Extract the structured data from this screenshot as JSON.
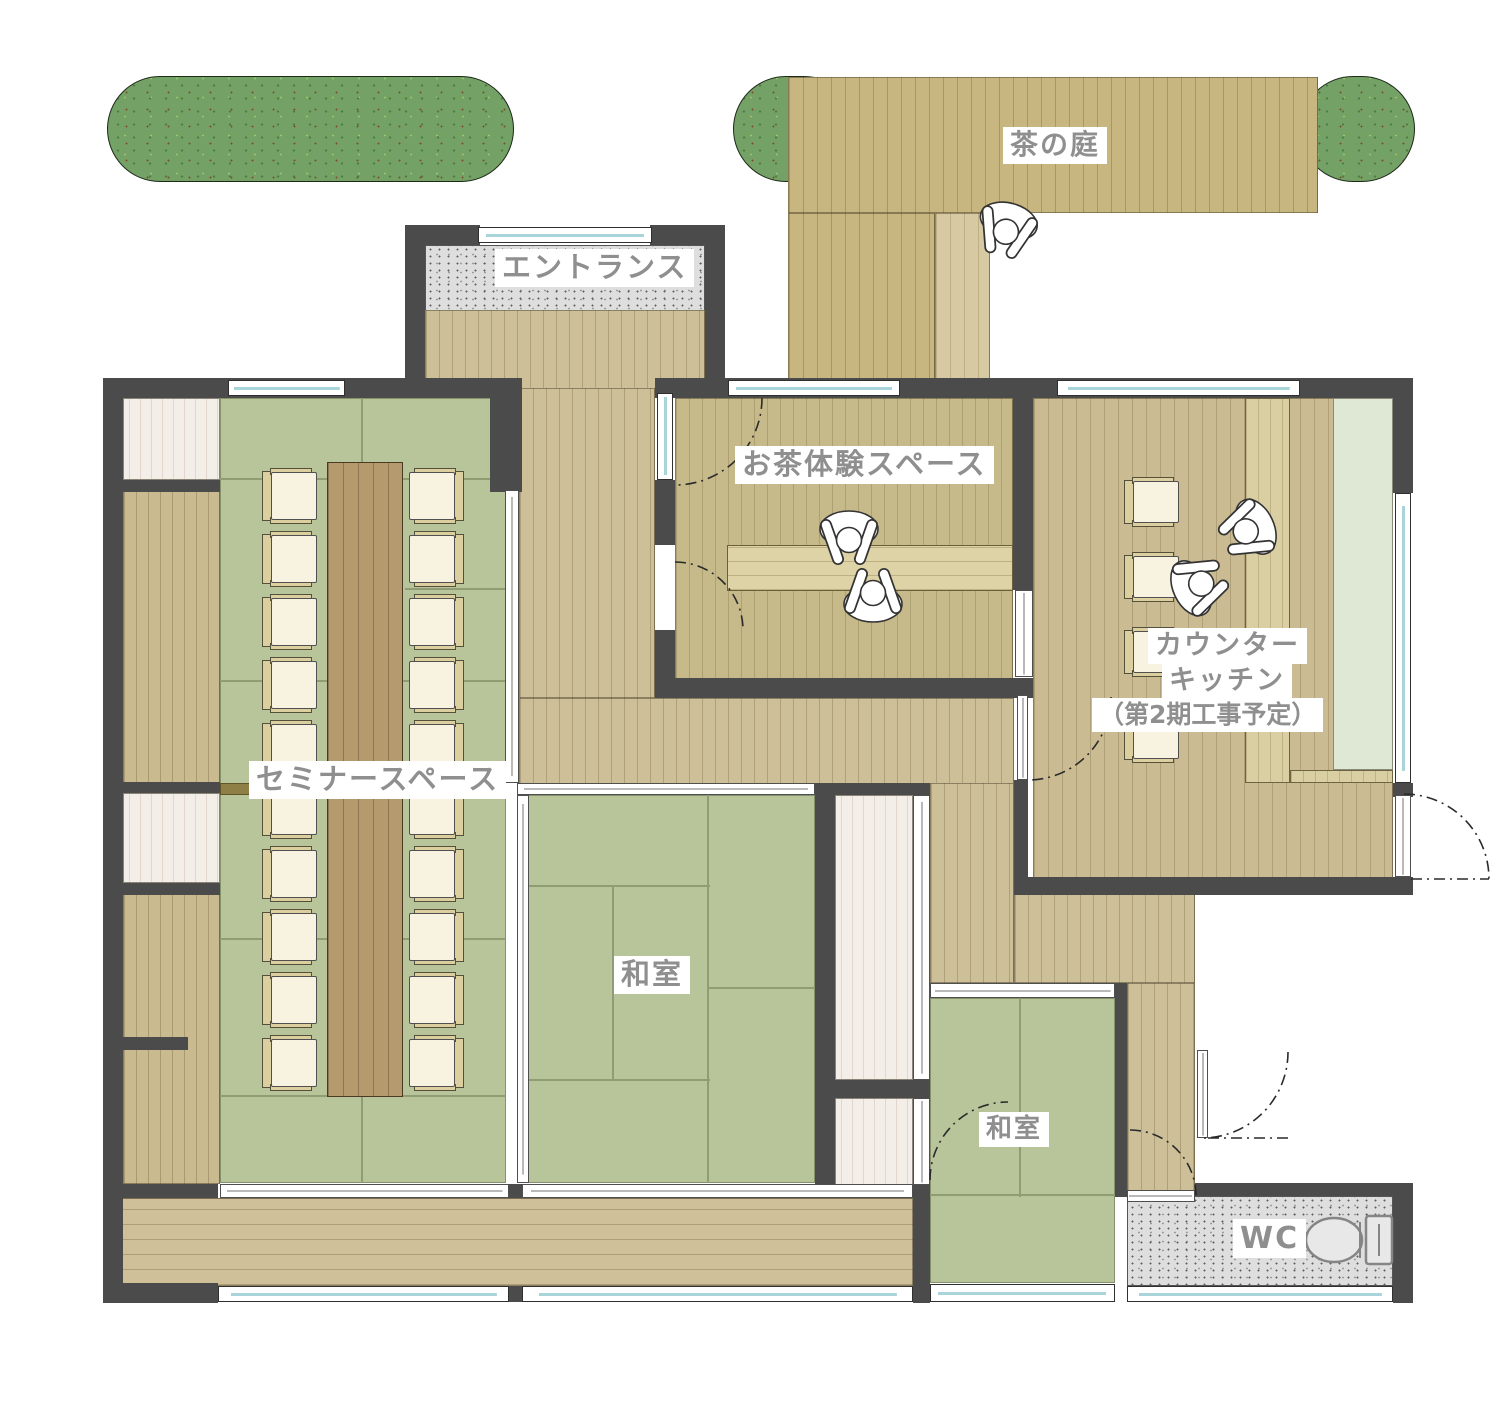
{
  "app": {
    "type": "architectural-floor-plan",
    "language": "ja"
  },
  "labels": {
    "garden": "茶の庭",
    "entrance": "エントランス",
    "tea_space": "お茶体験スペース",
    "counter_line1": "カウンター",
    "counter_line2": "キッチン",
    "counter_line3": "（第2期工事予定）",
    "seminar": "セミナースペース",
    "washitsu_main": "和室",
    "washitsu_small": "和室",
    "wc": "WC"
  },
  "furniture": {
    "seminar_chairs": 20,
    "kitchen_stools": 4,
    "seminar_table": 1,
    "tea_table": 1,
    "toilet": 1,
    "people_figures": 5,
    "hedges": 3
  },
  "colors": {
    "wall": "#4b4b4b",
    "wood_floor": "#cdbf97",
    "tatami": "#b8c59b",
    "hedge_green": "#74a166",
    "gravel": "#dedede",
    "closet": "#f3eee7",
    "kitchen_phase2_zone": "#dfe7d5",
    "label_text": "#8f8f8f",
    "glass": "#a9d5da"
  }
}
